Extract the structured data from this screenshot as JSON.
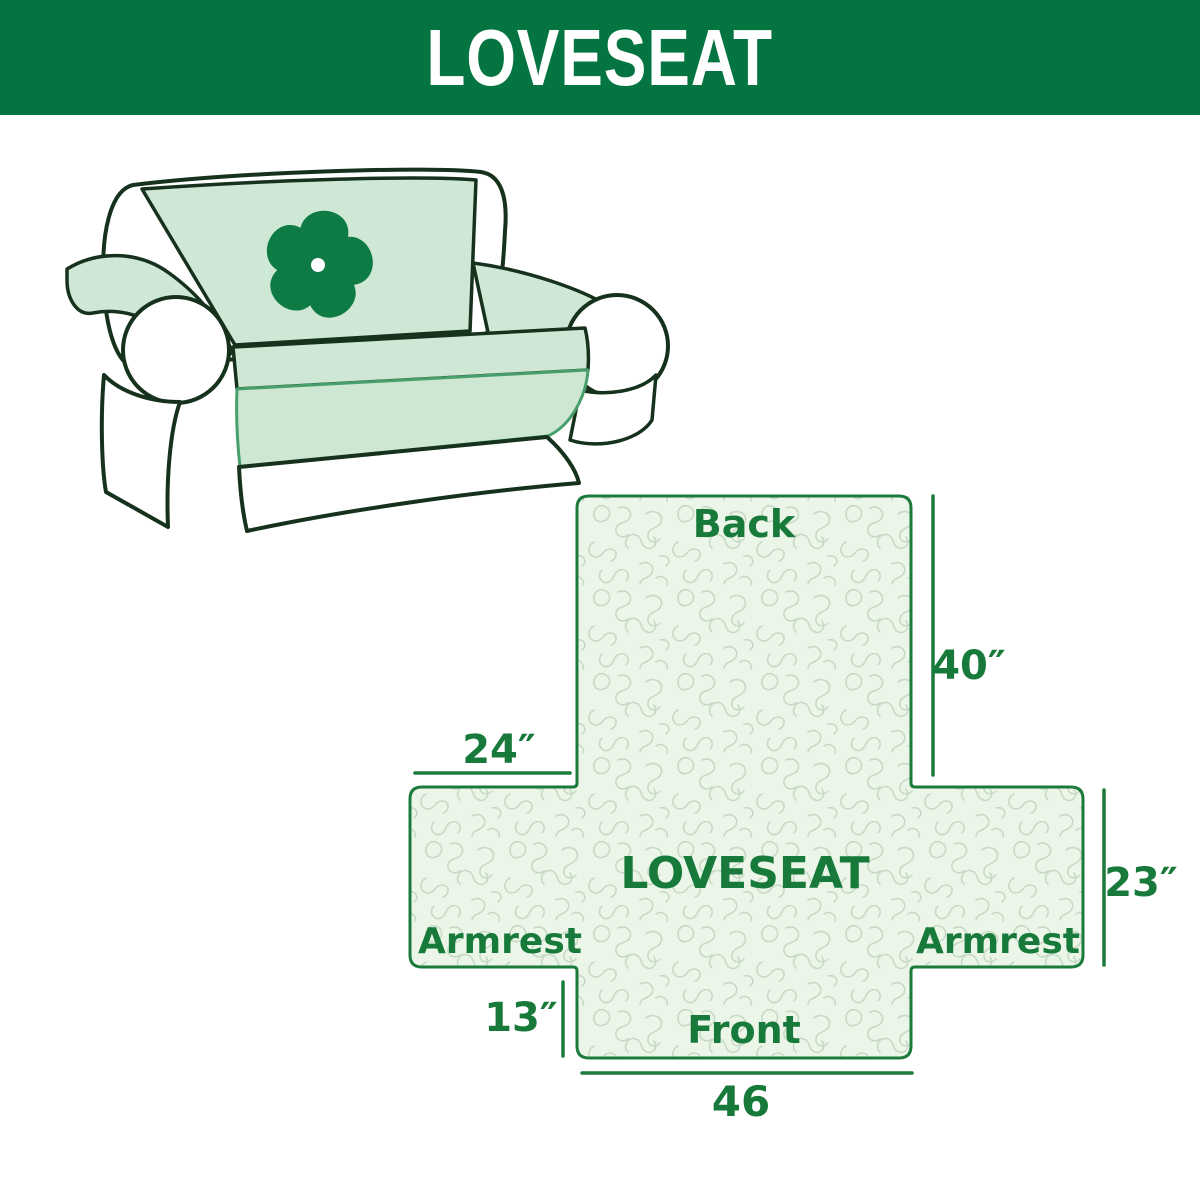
{
  "header": {
    "title": "LOVESEAT",
    "background_color": "#047540",
    "text_color": "#FFFFFF"
  },
  "sofa": {
    "description": "line drawing of a two-seat loveseat with mint slipcover",
    "cover_color": "#cfe8d6",
    "outline_color": "#16321d",
    "logo": "pinwheel-icon",
    "logo_color": "#0d7b43"
  },
  "diagram": {
    "center_label": "LOVESEAT",
    "labels": {
      "back": "Back",
      "front": "Front",
      "armrest_left": "Armrest",
      "armrest_right": "Armrest"
    },
    "measurements": {
      "back_height": "40″",
      "armrest_width": "24″",
      "seat_depth": "23″",
      "front_drop": "13″",
      "front_width": "46"
    },
    "colors": {
      "outline": "#1b7a3c",
      "text": "#17793a",
      "fill": "#ebf6e9",
      "pattern_line": "#c7dac5"
    }
  }
}
